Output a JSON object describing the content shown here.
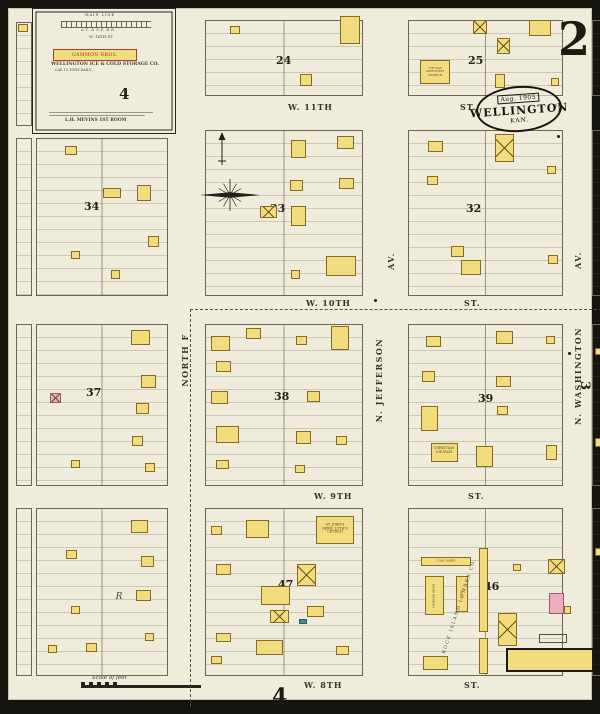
{
  "corner": {
    "sheet": "2",
    "bottom_sheet": "4",
    "right_sheet": "3"
  },
  "stamp": {
    "date": "Aug. 1905",
    "city": "WELLINGTON",
    "state": "KAN."
  },
  "inset": {
    "rail_line1": "MAIN LINE",
    "rail_line2": "A.T. & S.F. R.R.",
    "street": "W. 14TH ST.",
    "banner": "GAMMON BROS.",
    "company": "WELLINGTON ICE & COLD STORAGE CO.",
    "capacity": "CAP. 15 TONS DAILY.",
    "footnote": "L.H. MEVINS 1ST ROOM",
    "sheet_ref": "4"
  },
  "scale": {
    "label": "Scale of feet"
  },
  "colors": {
    "paper": "#efecdc",
    "frame": "#16140e",
    "building_yellow": "#f2dd7e",
    "building_pink": "#eaaec0",
    "building_black": "#2a271f",
    "building_teal": "#3f8f8a",
    "ink": "#2b2920"
  },
  "streets": {
    "horizontal": [
      {
        "name": "W. 11TH",
        "nx": 280,
        "suffix": "ST.",
        "sx": 452,
        "y": 94
      },
      {
        "name": "W. 10TH",
        "nx": 298,
        "suffix": "ST.",
        "sx": 456,
        "y": 290
      },
      {
        "name": "W. 9TH",
        "nx": 306,
        "suffix": "ST.",
        "sx": 460,
        "y": 483
      },
      {
        "name": "W. 8TH",
        "nx": 296,
        "suffix": "ST.",
        "sx": 456,
        "y": 672
      }
    ],
    "vertical": [
      {
        "text": "NORTH F",
        "x": 177,
        "y": 352
      },
      {
        "text": "N. JEFFERSON",
        "x": 371,
        "y": 372
      },
      {
        "text": "N. WASHINGTON",
        "x": 570,
        "y": 368
      },
      {
        "text": "AV.",
        "x": 383,
        "y": 253
      },
      {
        "text": "AV.",
        "x": 570,
        "y": 252
      }
    ]
  },
  "blocks": [
    {
      "x": 8,
      "y": 14,
      "w": 16,
      "h": 104
    },
    {
      "x": 197,
      "y": 12,
      "w": 158,
      "h": 76,
      "num": "24",
      "nx": 268,
      "ny": 46
    },
    {
      "x": 400,
      "y": 12,
      "w": 155,
      "h": 76,
      "num": "25",
      "nx": 460,
      "ny": 46
    },
    {
      "x": 584,
      "y": 12,
      "w": 12,
      "h": 76
    },
    {
      "x": 8,
      "y": 130,
      "w": 16,
      "h": 158
    },
    {
      "x": 28,
      "y": 130,
      "w": 132,
      "h": 158,
      "num": "34",
      "nx": 76,
      "ny": 192
    },
    {
      "x": 197,
      "y": 122,
      "w": 158,
      "h": 166,
      "num": "33",
      "nx": 262,
      "ny": 194
    },
    {
      "x": 400,
      "y": 122,
      "w": 155,
      "h": 166,
      "num": "32",
      "nx": 458,
      "ny": 194
    },
    {
      "x": 584,
      "y": 122,
      "w": 12,
      "h": 166
    },
    {
      "x": 8,
      "y": 316,
      "w": 16,
      "h": 162
    },
    {
      "x": 28,
      "y": 316,
      "w": 132,
      "h": 162,
      "num": "37",
      "nx": 78,
      "ny": 378
    },
    {
      "x": 197,
      "y": 316,
      "w": 158,
      "h": 162,
      "num": "38",
      "nx": 266,
      "ny": 382
    },
    {
      "x": 400,
      "y": 316,
      "w": 155,
      "h": 162,
      "num": "39",
      "nx": 470,
      "ny": 384
    },
    {
      "x": 584,
      "y": 316,
      "w": 12,
      "h": 162
    },
    {
      "x": 8,
      "y": 500,
      "w": 16,
      "h": 168
    },
    {
      "x": 28,
      "y": 500,
      "w": 132,
      "h": 168
    },
    {
      "x": 197,
      "y": 500,
      "w": 158,
      "h": 168,
      "num": "47",
      "nx": 270,
      "ny": 570
    },
    {
      "x": 400,
      "y": 500,
      "w": 155,
      "h": 168,
      "num": "46",
      "nx": 476,
      "ny": 572
    },
    {
      "x": 584,
      "y": 500,
      "w": 12,
      "h": 168
    }
  ],
  "buildings": [
    [
      10,
      16,
      10,
      8,
      "y",
      0
    ],
    [
      222,
      18,
      10,
      8,
      "y",
      0
    ],
    [
      332,
      8,
      20,
      28,
      "y",
      0
    ],
    [
      292,
      66,
      12,
      12,
      "y",
      0
    ],
    [
      412,
      52,
      30,
      24,
      "y",
      0
    ],
    [
      465,
      12,
      14,
      14,
      "y",
      1
    ],
    [
      521,
      12,
      22,
      16,
      "y",
      0
    ],
    [
      489,
      30,
      13,
      16,
      "y",
      1
    ],
    [
      487,
      66,
      10,
      14,
      "y",
      0
    ],
    [
      543,
      70,
      8,
      8,
      "y",
      0
    ],
    [
      57,
      138,
      12,
      9,
      "y",
      0
    ],
    [
      95,
      180,
      18,
      10,
      "y",
      0
    ],
    [
      129,
      177,
      14,
      16,
      "y",
      0
    ],
    [
      140,
      228,
      11,
      11,
      "y",
      0
    ],
    [
      103,
      262,
      9,
      9,
      "y",
      0
    ],
    [
      63,
      243,
      9,
      8,
      "y",
      0
    ],
    [
      283,
      132,
      15,
      18,
      "y",
      0
    ],
    [
      329,
      128,
      17,
      13,
      "y",
      0
    ],
    [
      282,
      172,
      13,
      11,
      "y",
      0
    ],
    [
      331,
      170,
      15,
      11,
      "y",
      0
    ],
    [
      252,
      198,
      17,
      12,
      "y",
      1
    ],
    [
      283,
      198,
      15,
      20,
      "y",
      0
    ],
    [
      318,
      248,
      30,
      20,
      "y",
      0
    ],
    [
      283,
      262,
      9,
      9,
      "y",
      0
    ],
    [
      420,
      133,
      15,
      11,
      "y",
      0
    ],
    [
      487,
      126,
      19,
      28,
      "y",
      1
    ],
    [
      419,
      168,
      11,
      9,
      "y",
      0
    ],
    [
      443,
      238,
      13,
      11,
      "y",
      0
    ],
    [
      453,
      252,
      20,
      15,
      "y",
      0
    ],
    [
      539,
      158,
      9,
      8,
      "y",
      0
    ],
    [
      540,
      247,
      10,
      9,
      "y",
      0
    ],
    [
      123,
      322,
      19,
      15,
      "y",
      0
    ],
    [
      133,
      367,
      15,
      13,
      "y",
      0
    ],
    [
      42,
      385,
      11,
      10,
      "p",
      1
    ],
    [
      128,
      395,
      13,
      11,
      "y",
      0
    ],
    [
      124,
      428,
      11,
      10,
      "y",
      0
    ],
    [
      63,
      452,
      9,
      8,
      "y",
      0
    ],
    [
      137,
      455,
      10,
      9,
      "y",
      0
    ],
    [
      203,
      328,
      19,
      15,
      "y",
      0
    ],
    [
      238,
      320,
      15,
      11,
      "y",
      0
    ],
    [
      323,
      318,
      18,
      24,
      "y",
      0
    ],
    [
      208,
      353,
      15,
      11,
      "y",
      0
    ],
    [
      288,
      328,
      11,
      9,
      "y",
      0
    ],
    [
      203,
      383,
      17,
      13,
      "y",
      0
    ],
    [
      299,
      383,
      13,
      11,
      "y",
      0
    ],
    [
      208,
      418,
      23,
      17,
      "y",
      0
    ],
    [
      288,
      423,
      15,
      13,
      "y",
      0
    ],
    [
      208,
      452,
      13,
      9,
      "y",
      0
    ],
    [
      328,
      428,
      11,
      9,
      "y",
      0
    ],
    [
      287,
      457,
      10,
      8,
      "y",
      0
    ],
    [
      418,
      328,
      15,
      11,
      "y",
      0
    ],
    [
      488,
      323,
      17,
      13,
      "y",
      0
    ],
    [
      538,
      328,
      9,
      8,
      "y",
      0
    ],
    [
      414,
      363,
      13,
      11,
      "y",
      0
    ],
    [
      488,
      368,
      15,
      11,
      "y",
      0
    ],
    [
      413,
      398,
      17,
      25,
      "y",
      0
    ],
    [
      489,
      398,
      11,
      9,
      "y",
      0
    ],
    [
      423,
      435,
      27,
      19,
      "y",
      0
    ],
    [
      468,
      438,
      17,
      21,
      "y",
      0
    ],
    [
      538,
      437,
      11,
      15,
      "y",
      0
    ],
    [
      587,
      340,
      8,
      7,
      "y",
      0
    ],
    [
      587,
      430,
      8,
      9,
      "y",
      0
    ],
    [
      123,
      512,
      17,
      13,
      "y",
      0
    ],
    [
      133,
      548,
      13,
      11,
      "y",
      0
    ],
    [
      58,
      542,
      11,
      9,
      "y",
      0
    ],
    [
      128,
      582,
      15,
      11,
      "y",
      0
    ],
    [
      63,
      598,
      9,
      8,
      "y",
      0
    ],
    [
      78,
      635,
      11,
      9,
      "y",
      0
    ],
    [
      40,
      637,
      9,
      8,
      "y",
      0
    ],
    [
      137,
      625,
      9,
      8,
      "y",
      0
    ],
    [
      308,
      508,
      38,
      28,
      "y",
      0
    ],
    [
      238,
      512,
      23,
      18,
      "y",
      0
    ],
    [
      203,
      518,
      11,
      9,
      "y",
      0
    ],
    [
      289,
      556,
      19,
      22,
      "y",
      1
    ],
    [
      208,
      556,
      15,
      11,
      "y",
      0
    ],
    [
      253,
      578,
      29,
      19,
      "y",
      0
    ],
    [
      262,
      602,
      19,
      13,
      "y",
      1
    ],
    [
      299,
      598,
      17,
      11,
      "y",
      0
    ],
    [
      208,
      625,
      15,
      9,
      "y",
      0
    ],
    [
      248,
      632,
      27,
      15,
      "y",
      0
    ],
    [
      328,
      638,
      13,
      9,
      "y",
      0
    ],
    [
      291,
      611,
      8,
      5,
      "t",
      0
    ],
    [
      203,
      648,
      11,
      8,
      "y",
      0
    ],
    [
      413,
      549,
      50,
      9,
      "y",
      0
    ],
    [
      417,
      568,
      19,
      39,
      "y",
      0
    ],
    [
      448,
      568,
      12,
      36,
      "y",
      0
    ],
    [
      471,
      540,
      9,
      84,
      "y",
      0
    ],
    [
      471,
      630,
      9,
      36,
      "y",
      0
    ],
    [
      490,
      605,
      19,
      33,
      "y",
      1
    ],
    [
      540,
      551,
      17,
      15,
      "y",
      1
    ],
    [
      541,
      585,
      15,
      21,
      "p",
      0
    ],
    [
      556,
      598,
      7,
      8,
      "y",
      0
    ],
    [
      505,
      556,
      8,
      7,
      "y",
      0
    ],
    [
      531,
      626,
      28,
      9,
      "o",
      0
    ],
    [
      498,
      640,
      88,
      24,
      "Y",
      0
    ],
    [
      415,
      648,
      25,
      14,
      "y",
      0
    ],
    [
      587,
      540,
      8,
      8,
      "y",
      0
    ],
    [
      48,
      57,
      74,
      52,
      "p",
      0
    ],
    [
      48,
      95,
      44,
      16,
      "p",
      0
    ],
    [
      122,
      84,
      26,
      18,
      "p",
      0
    ],
    [
      100,
      60,
      15,
      22,
      "y",
      1
    ],
    [
      117,
      60,
      13,
      20,
      "k",
      0
    ],
    [
      140,
      86,
      13,
      13,
      "y",
      1
    ]
  ],
  "poi": [
    {
      "t": "7TH DAY\nADVENTIST\nCHURCH",
      "x": 427,
      "y": 64,
      "s": 3,
      "w": 30
    },
    {
      "t": "CHRISTIAN\nCHURCH",
      "x": 436,
      "y": 443,
      "s": 3.4,
      "w": 30
    },
    {
      "t": "ST. JOHN'S\nGERM. LUTH'N\nCHURCH",
      "x": 327,
      "y": 521,
      "s": 3.2,
      "w": 36
    },
    {
      "t": "ROCK ISLAND LUMBER CO.",
      "x": 452,
      "y": 598,
      "s": 4.6,
      "r": -72,
      "ls": 1.5
    },
    {
      "t": "COAL SHED",
      "x": 438,
      "y": 553,
      "s": 3
    },
    {
      "t": "LUMBER SHED",
      "x": 426,
      "y": 588,
      "s": 3,
      "r": -90
    },
    {
      "t": "COAL",
      "x": 454,
      "y": 586,
      "s": 3,
      "r": -90
    },
    {
      "t": "R",
      "x": 111,
      "y": 589,
      "s": 9,
      "i": 1
    }
  ],
  "dots": [
    [
      366,
      291
    ],
    [
      546,
      96
    ],
    [
      549,
      127
    ],
    [
      560,
      344
    ],
    [
      592,
      652
    ]
  ]
}
